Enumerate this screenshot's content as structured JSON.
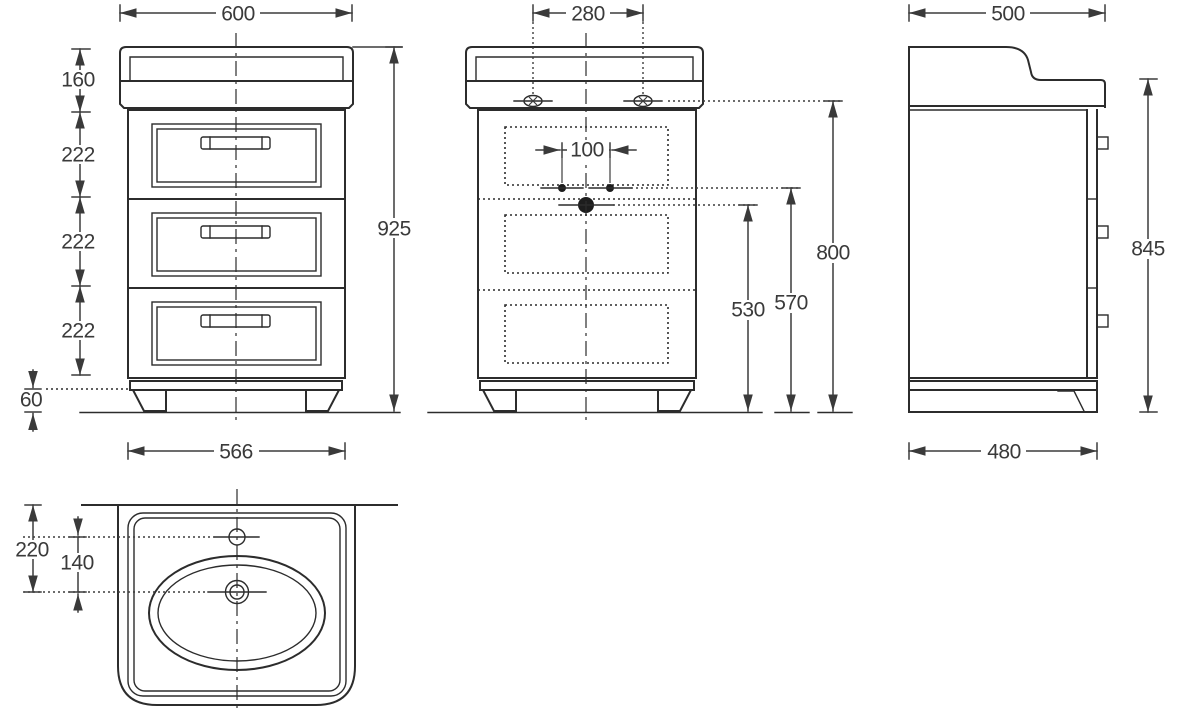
{
  "drawing": {
    "type": "technical-dimension-drawing",
    "subject": "vanity unit with washbasin, three drawers",
    "colors": {
      "background": "#ffffff",
      "line": "#2c2c2c",
      "dimension": "#3a3a3a"
    },
    "front_view": {
      "dims": {
        "top_width": "600",
        "upstand_height": "160",
        "drawer1_height": "222",
        "drawer2_height": "222",
        "drawer3_height": "222",
        "plinth_height": "60",
        "total_height": "925",
        "carcass_width": "566"
      }
    },
    "section_view": {
      "dims": {
        "fixing_span": "280",
        "tap_hole_span": "100",
        "drain_height": "530",
        "tap_height": "570",
        "fixing_height": "800"
      }
    },
    "side_view": {
      "dims": {
        "top_depth": "500",
        "side_height": "845",
        "carcass_depth": "480"
      }
    },
    "basin_view": {
      "dims": {
        "rim_to_drain": "220",
        "tap_to_drain": "140"
      }
    }
  }
}
